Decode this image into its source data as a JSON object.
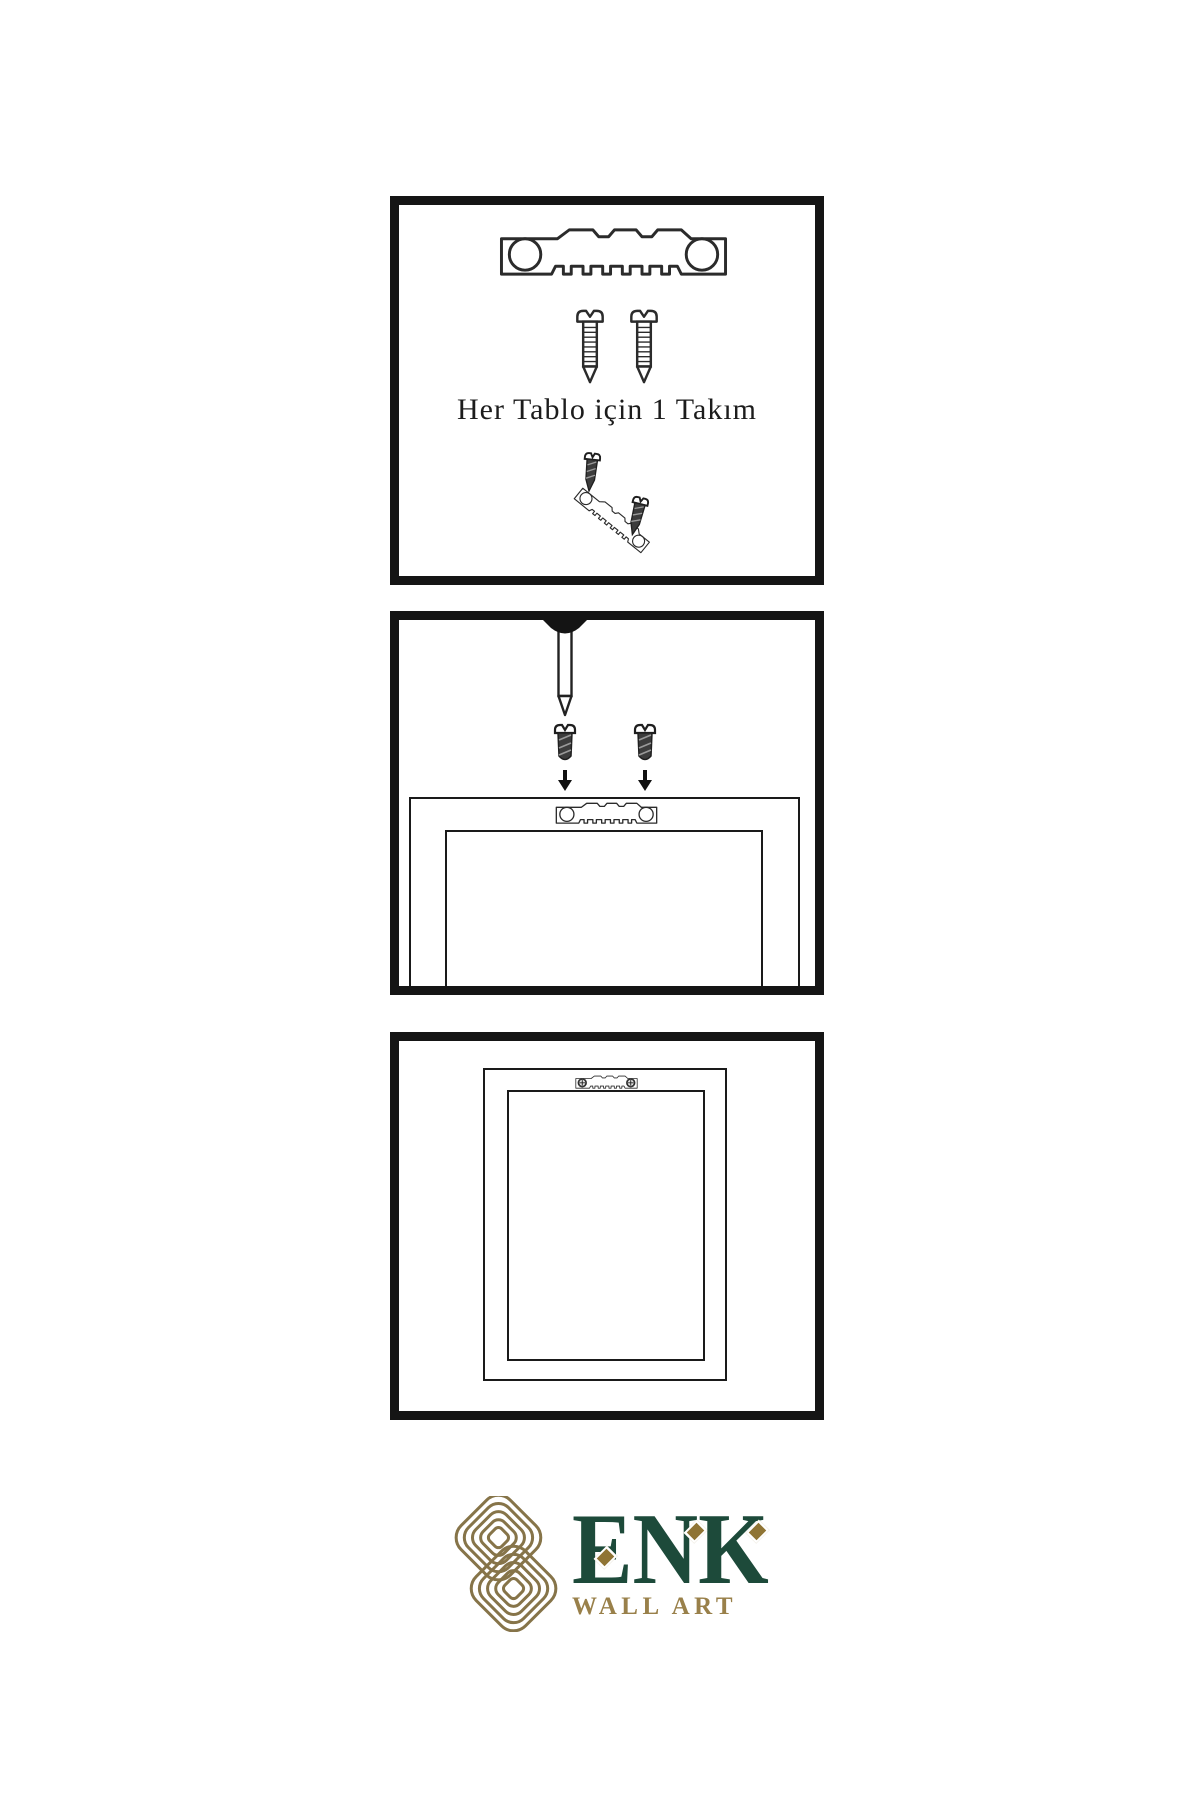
{
  "instructions": {
    "step1_caption": "Her Tablo için 1 Takım"
  },
  "brand": {
    "name": "ENK",
    "subtitle": "WALL ART",
    "colors": {
      "text_green": "#1d4a3a",
      "accent_gold": "#99804a",
      "knot_gold": "#867449",
      "line_black": "#151515"
    }
  }
}
